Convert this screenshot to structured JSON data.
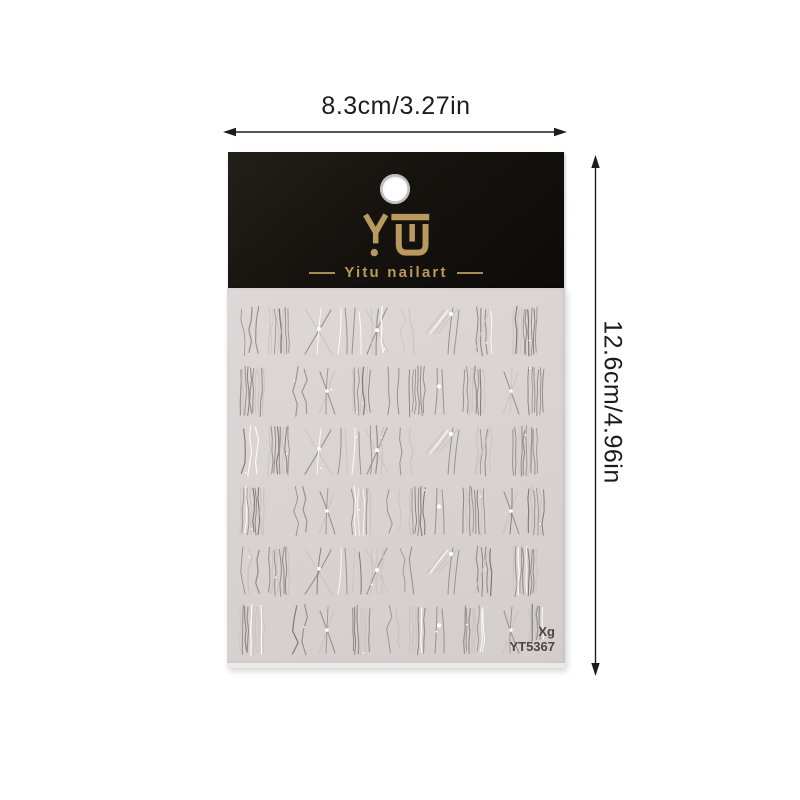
{
  "dimensions": {
    "width_label": "8.3cm/3.27in",
    "height_label": "12.6cm/4.96in",
    "line_color": "#1c1c1c"
  },
  "package": {
    "logo_text": "YU",
    "brand_name": "Yitu nailart",
    "header_bg": "#16130f",
    "gold": "#b89a5e"
  },
  "sheet": {
    "bg": "#d8d2d1",
    "size_code": "Xg",
    "model_number": "YT5367",
    "label_color": "#4b4643",
    "pattern": {
      "rows": [
        {
          "kind": "a",
          "y": 20
        },
        {
          "kind": "b",
          "y": 80
        },
        {
          "kind": "a",
          "y": 140
        },
        {
          "kind": "b",
          "y": 200
        },
        {
          "kind": "a",
          "y": 260
        },
        {
          "kind": "b",
          "y": 319
        }
      ],
      "slots_a": [
        "sparse3",
        "dense8",
        "bigX",
        "pair2",
        "xlines",
        "sparse2",
        "diag4",
        "mixed5",
        "dense10"
      ],
      "slots_b": [
        "dense10",
        "sparse2",
        "smallx",
        "dense7",
        "sparse2",
        "dense6",
        "knot3",
        "dense8",
        "smallx",
        "dense6"
      ],
      "centers_a": [
        23,
        52,
        92,
        122,
        150,
        180,
        218,
        257,
        298
      ],
      "centers_b": [
        25,
        73,
        100,
        134,
        167,
        190,
        213,
        247,
        284,
        309
      ],
      "line_height": 46,
      "stroke_mid": "#958f8c",
      "stroke_light": "#c9c3c1",
      "stroke_white": "#fdfdfc",
      "stroke_dark": "#7b7673"
    }
  }
}
